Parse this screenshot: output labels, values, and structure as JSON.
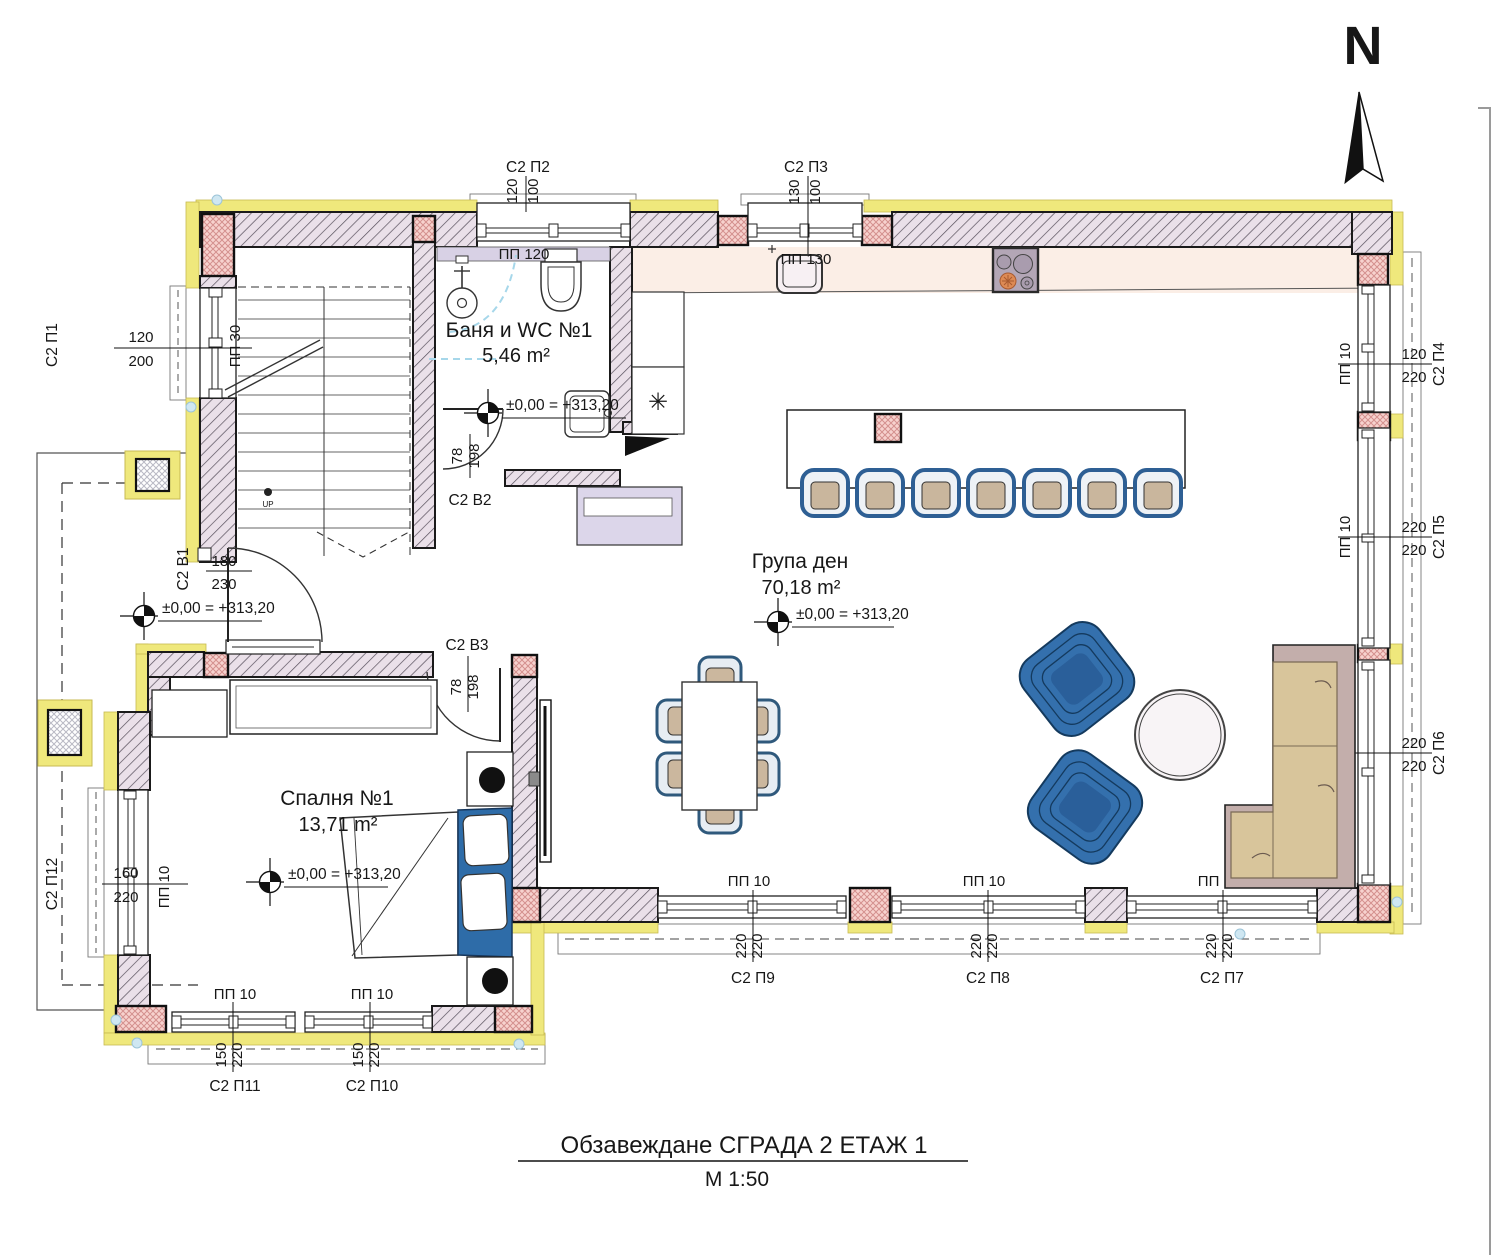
{
  "page": {
    "title_line1": "Обзавеждане СГРАДА 2 ЕТАЖ 1",
    "title_line2": "М 1:50"
  },
  "north": {
    "letter": "N"
  },
  "elevation": {
    "text": "±0,00 = +313,20"
  },
  "rooms": {
    "bath": {
      "name": "Баня и WC №1",
      "area": "5,46 m²"
    },
    "living": {
      "name": "Група ден",
      "area": "70,18 m²"
    },
    "bedroom": {
      "name": "Спалня №1",
      "area": "13,71 m²"
    }
  },
  "labels": {
    "pp10": "ПП 10",
    "pp30": "ПП 30",
    "pp120": "ПП 120",
    "pp130": "ПП 130",
    "up": "UP"
  },
  "icons": {
    "snowflake": "✳"
  },
  "openings": {
    "p1": {
      "tag": "С2 П1",
      "dim1": "120",
      "dim2": "200"
    },
    "p2": {
      "tag": "С2 П2",
      "dim1": "120",
      "dim2": "100"
    },
    "p3": {
      "tag": "С2 П3",
      "dim1": "130",
      "dim2": "100"
    },
    "p4": {
      "tag": "С2 П4",
      "dim1": "120",
      "dim2": "220"
    },
    "p5": {
      "tag": "С2 П5",
      "dim1": "220",
      "dim2": "220"
    },
    "p6": {
      "tag": "С2 П6",
      "dim1": "220",
      "dim2": "220"
    },
    "p7": {
      "tag": "С2 П7",
      "dim1": "220",
      "dim2": "220"
    },
    "p8": {
      "tag": "С2 П8",
      "dim1": "220",
      "dim2": "220"
    },
    "p9": {
      "tag": "С2 П9",
      "dim1": "220",
      "dim2": "220"
    },
    "p10": {
      "tag": "С2 П10",
      "dim1": "150",
      "dim2": "220"
    },
    "p11": {
      "tag": "С2 П11",
      "dim1": "150",
      "dim2": "220"
    },
    "p12": {
      "tag": "С2 П12",
      "dim1": "160",
      "dim2": "220"
    },
    "v1": {
      "tag": "С2 В1",
      "dim1": "180",
      "dim2": "230"
    },
    "v2": {
      "tag": "С2 В2",
      "dim1": "78",
      "dim2": "198"
    },
    "v3": {
      "tag": "С2 В3",
      "dim1": "78",
      "dim2": "198"
    }
  },
  "colors": {
    "insulation": "#efe87c",
    "wall_fill": "#eae0e9",
    "column_fill": "#f7d2ce",
    "furniture_blue": "#3470ad",
    "sofa_tan": "#d8c59b",
    "sofa_back": "#c3aeab",
    "kitchen_floor": "#fbeee6"
  }
}
